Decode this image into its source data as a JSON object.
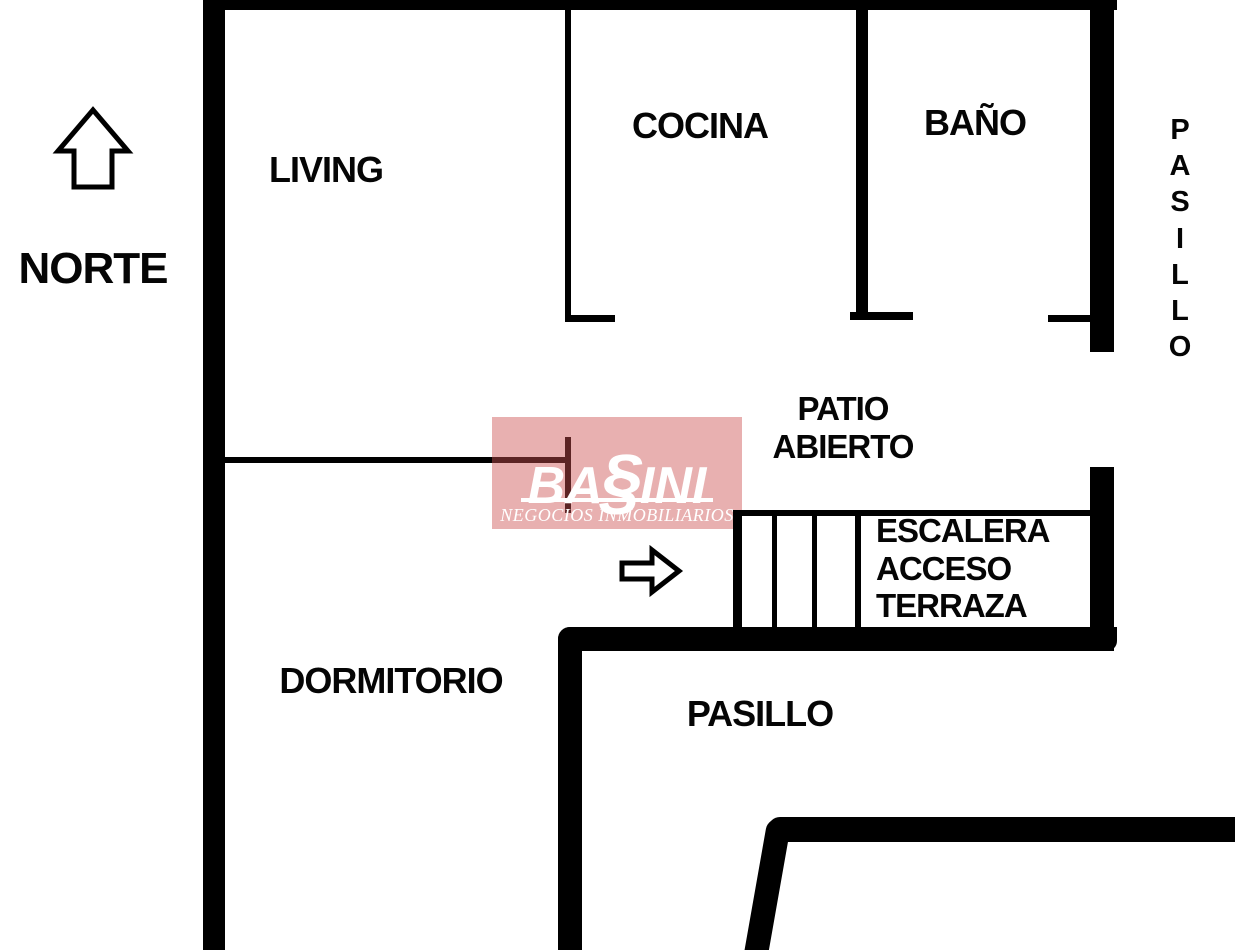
{
  "compass": {
    "label": "NORTE"
  },
  "rooms": {
    "living": "LIVING",
    "kitchen": "COCINA",
    "bathroom": "BAÑO",
    "hallway_right_vertical": "P\nA\nS\nI\nL\nL\nO",
    "patio": "PATIO\nABIERTO",
    "stairs": "ESCALERA\nACCESO\nTERRAZA",
    "bedroom": "DORMITORIO",
    "hallway_bottom": "PASILLO"
  },
  "watermark": {
    "brand_prefix": "BA",
    "brand_s": "§",
    "brand_suffix": "INI",
    "subtitle": "NEGOCIOS INMOBILIARIOS"
  },
  "colors": {
    "background": "#ffffff",
    "wall": "#000000",
    "label_text": "#050505",
    "watermark_overlay": "rgba(205,80,80,0.45)",
    "watermark_text": "#ffffff"
  }
}
